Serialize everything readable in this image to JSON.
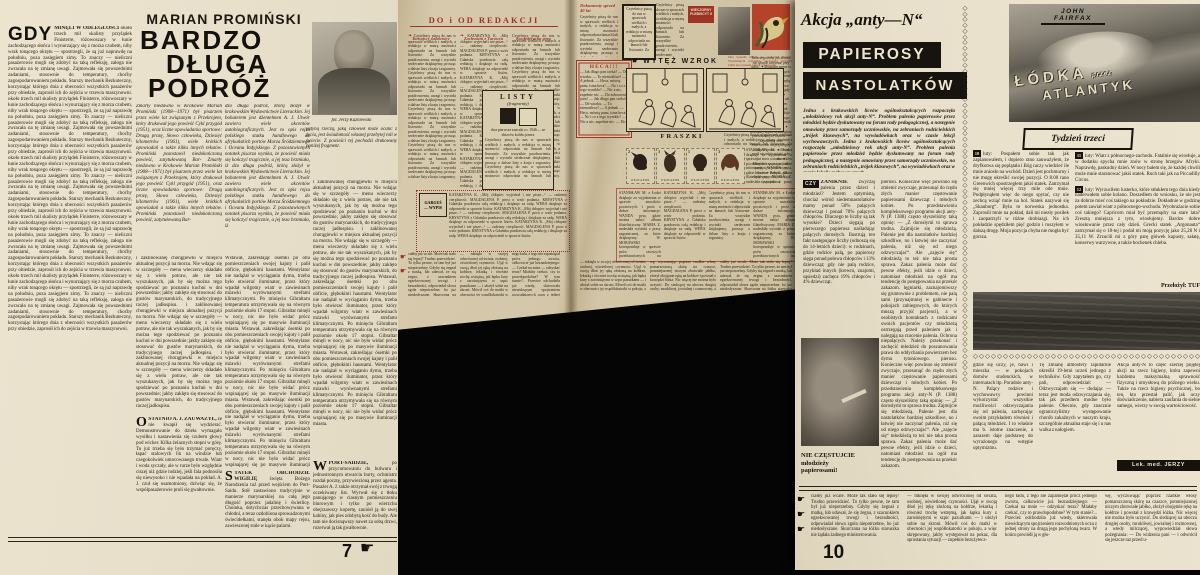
{
  "colors": {
    "background": "#050505",
    "paper_light": "#e8e0cb",
    "paper_tan": "#d4c7a9",
    "ink": "#262016",
    "accent_red": "#9e3425",
    "block_black": "#17130e",
    "stamp_dogs": [
      "#2b2019",
      "#3a2c1f",
      "#322418",
      "#5a3a22"
    ]
  },
  "icons": {
    "hand": "☛",
    "floret": "❧",
    "zigzag": "◇",
    "sep": "✦"
  },
  "p7": {
    "page_number": "7",
    "kicker": "MARIAN PROMIŃSKI",
    "title1": "BARDZO",
    "title2": "DŁUGA",
    "title3": "PODRÓŻ",
    "lead_cap": "GDY",
    "lead_bold": "MINĘLI W ODLEGŁOŚCI",
    "photo_caption": "fot. Jerzy Kuźniewski",
    "secS_cap": "S",
    "secS_head": "TATEK OBCHODZIŁ WIGILIĘ",
    "secW_cap": "W",
    "secW_head": "PORT-SAIDZIE,",
    "secO_cap": "O",
    "secO_head": "STATNIO A. J. ZAUWAŻYŁ,"
  },
  "spread": {
    "header": "DO i OD REDAKCJI",
    "letter_title_1": "Tarnajscy sadownicy",
    "letter_title_2": "Zachwiani z Turowca",
    "letter_title_3": "Konfederacka góra",
    "listy_title": "LISTY",
    "listy_sub": "(fragmenty)",
    "listy_caption": "dwa pierwsze znaczki z r. 1946 — ze zbiorów kolekcjonera",
    "gargus_1": "GARGUŚ",
    "gargus_2": "— WYPIS",
    "doc_title": "Dokumenty sprzed 40 lat",
    "plebiscyt_1": "WIECZORNY",
    "plebiscyt_2": "PLEBISCYT II",
    "heca_title": "HECA!!!",
    "wytez_title": "WYTĘŻ WZROK",
    "wytez_note": "Oba rysunki różnią się pozornie niczym. Wyszukajcie wszystkie szczegóły, którymi różni się rysunek prawy od lewego.",
    "fraszki": "FRASZKI",
    "stamp_label": "БЪЛГАРИЯ",
    "stamp_values": [
      "2",
      "3",
      "1",
      "3"
    ]
  },
  "p10": {
    "kicker": "Akcja „anty—N“",
    "block1": "PAPIEROSY",
    "block2": "NASTOLATKÓW",
    "drop": "CZY",
    "drop_bold": "ZANIKNIE",
    "photo_caption_1": "NIE CZĘSTUJCIE",
    "photo_caption_2": "młodzieży",
    "photo_caption_3": "papierosami!",
    "signature": "Lek. med. JERZY BIRCZYŃSKI",
    "page_number": "10",
    "lodka": {
      "author": "JOHN FAIRFAX",
      "title_1": "ŁÓDKA",
      "title_mid": "przez",
      "title_2": "ATLANTYK",
      "subtitle": "Tydzień trzeci",
      "translator": "Przełożył: TUF",
      "e10_n": "10",
      "e11_n": "11",
      "e12_n": "12"
    }
  },
  "t": {
    "p7_col1": "około trzech mil skalisty przylądek Finisterre, różowoszary w łunie zachodzącego słońca i wynurzający się z morza czubem, niby wrak tonącego okrętu — spostrzegli, że są już naprawdę na południu, poza zasięgiem zimy. To znaczy — nieliczni pasażerowie mogli się zdobyć na taką refleksję, załoga nie zwracała na tę zmianę uwagi. Zajmowała się powszednimi zadaniami, stosownie do temperatury, choćby zagospodarowaniem pokładu. Starszy mechanik Bezkuteczny, korzystając którego dnia z obecności wszystkich pasażerów przy obiedzie, zaprosił ich do zejścia w trzewia maszynowni.",
    "p7_intro_a": "Zmarły niedawno w Krakowie Marian Promiński (1908—1971) był pisarzem przez wiele lat związanym z Przekrojem, który drukował jego powieść Cykl przygód (1951), oraz liczne opowiadania sportowe: Drugą prozę, Słowo człowieka, Dziesięć kilometrów (1961), wiele krótkich opowiadań a także kilka innych tekstów. Promiński pozostawił niedokończoną powieść, zatytułowaną Bar-",
    "p7_intro_b": "dzo długa podróż, którą złożył w krakowskim Wydawnictwie Literackim. Jej bohaterem jest dżentelmen A. J. Utwór zawiera wiele akcentów autobiograficznych. Jest to opis rejsu polskiego statku handlowego do afrykańskich portów Morza Śródziemnego i Oceanu Indyjskiego. Z pozostawionych notatek pisarza wynika, że powieść miała się kończyć tragicznie, a jej teza brzmiała, iż",
    "p7_note": "jedyną rzeczą, jaką człowiek może ocalić z życia, jest świadomość własnej przebytej roli w świecie. Z powieści tej pochodzi drukowany poniżej fragment.",
    "p7_body1": "i zaklinowanej chorągiewki w miejscu aktualnej pozycji na morzu. Nie wdając się w szczegóły — menu wieczerzy składało się z wielu potraw, ale nie tak wyszukanych, jak by się można tego spodziewać po poznaniu kuchni w dni powszednie; jakby zaklęto się stosować do gustów marynarskich, do tradycyjnego raczej jadłospisu.",
    "p7_body2": "Wstawał, zakreślając ósemki po obu pomieszczeniach swojej kajuty i palił obficie, głębokimi haustami. Wentylator nie nadążał w wyciąganiu dymu, trzeba było otwierać iluminator, przez który wpadał wilgotny wiatr w zawiesinach mżawki wyrównanymi strefami klimatycznymi. Po minięciu Gibraltaru temperatura utrzymywała się na równym poziomie około 17 stopni. Gibraltar minęli w nocy, nic nie było widać prócz wspinającej się po masywie iluminacji miasta.",
    "p7_secS": "święta Bożego Narodzenia tuż przed wejściem do Port-Saidu. Stół zastawiono tradycyjnie w manierze marynarskiej na całą jego długość poprzez jadalnię i świetlicę. Choinka, dotychczas przechowywana w chłodni, a teraz ozdobiona sprowadzonymi świecidełkami, stanęła obok mapy rejsu, zawieszonej stale w kącie palarni.",
    "p7_secW": "po przycumowaniu do bulwaru i jednostronnym otwarciu burty, ochmistrz rozdał pocztę, przywiezioną przez agenta. Pasażer A. J. także otrzymał swój z trwogą oczekiwany list. Wyrwał się z tłoku panującego w ciasnym pomieszczeniu biurowym i tylko po wierzchu obejrzawszy kopertę, zaniósł ją do swej kabiny, jak pies zdobytą kość do budy. Ale tam nie docisnąwszy nawet za sobą drzwi, rozerwał ją tak gwałtownie.",
    "p7_secO": "że nie kwapił się wydzierać. Demonstrowanie do dzieła wymagało wysiłku i nastawienia się czubem głowy pod wicher. Kilka żelaznych stopni w górę. Tu już trzeba się było trzymać poręczy, łapać stalowych lin na windzie lub czegokolwiek umocowanego trwale. Wiatr i woda syczały, ale w rurze było względnie ciszej niż gdzie indziej, jeśli fala podnosiła się niewysoko i nie wpadała na pokład. A. J. czuł się osamotniony, dziwiąc się, że współpasażerowie pruli się gwałtownie.",
    "sp_fill": "Czytelnicy piszą do nas w sprawach wielkich i małych, a redakcja w miarę możności odpowiada na łamach lub listownie. Za wszystkie pozdrowienia, uwagi i wycinki serdecznie dziękujemy, prosząc o dalsze listy z kraju i zagranicy.",
    "sp_letters": "KATARZYNA K. „Mój chłopiec wyjechał i nie pisze...“ — radzimy cierpliwość. MAGDALENA P. prosi o wzór podania. KRYSTYNA z Gdańska pozdrawia całą redakcję i dziękuje za radę. WERA dziękuje za odpowiedź w sprawie listów.",
    "sp_letters2": "STANISŁAW M. z Łodzi dziękuje za wyjaśnienia w sprawie znaczków pocztowych i prosi o dalsze informacje. WANDA pyta, gdzie można nabyć album filatelistyczny. MARIA Z. nadesłała wycinki z prasy zagranicznej, za które dziękujemy. W. MORAWSKI koresponduje w sprawie psów rasowych przedstawionych na bułgarskich znaczkach.",
    "sp_heca": "— Jak długo pan czeka? — Od wtorku. — To niemożliwe! — A jednak. — Heca, mówię panu, istna heca! — No i co z tego wynikło? — Nic a nic, zupełnie nic. — Do zobaczenia jutro!",
    "sp_aph": "Twórczego żalu, jak dżemu, nie sposób utrzymać przy sobie. ✦ Rozsądny zapas to kalendarz przewidzianych błędów. ✦ Najtrudniej mieć zmartwienie na przyczepkę cudzych spraw. ✦ Nowa myśl nie zdąży zsiąść, gdy już stara wsiada. ✦ Młodzieńcze, pragnij, ale pamiętaj o powrotnym bilecie. ✦ Prawda, jak zwykle pospolita, nie daje się zacytować.",
    "anty_lead": "Jedna z krakowskich liceów ogólnokształcących rozpoczęła „młodzieżowy rok akcji anty-N“. Problem palenia papierosów przez młodzież będzie dyskutowany na forum rady pedagogicznej, a następnie omawiany przez samorządy uczniowskie, na zebraniach rodzicielskich „trójek klasowych“, na wywiadówkach oraz w czasie lekcji wychowawczych.",
    "anty_c1": "zwyczaj palenia przez dzieci i młodzież? Jestem optymistą, chociaż wśród siedemnastolatków mamy ponad 50% palących dziewcząt i ponad 70% palących chłopców. Dlaczego te liczby są tak wysokie? Dzieci sięgają po pierwszego papierosa naśladując palących dorosłych. Ilustrują ten fakt następujące liczby (odnoszą się do 14-letnich dzieci): w rodzinach, gdzie rodzice palą, po papierosy sięga ponad połowa chłopców i 13% dziewcząt; gdy nie palą rodzice, przykład innych (krewni, znajomi, sąsiedzi) zachęca 19% chłopców i 4% dziewcząt.",
    "anty_c2": "pierosu. Konieczne więc powinno się zmienić zwyczaje, przesunąć do rzędu złych manier częstowanie papierosami dziewcząt i młodych kobiet. Po przedstawieniu kompleksowego programu akcji anty-N (P. 1388) często słyszeliśmy taką opinię: — „Z dorosłymi to sprawa trudna. Zajmijcie się młodzieżą. Palenie jest dla nastolatków bardziej szkodliwe, no i łatwiej nie zaczynać palenia, niż się od niego odzwyczajać“. Ale „zajęcie się“ młodzieżą to też nie taka prosta sprawa. Zakaz palenia może dać pewne efekty, jeśli idzie o dzieci, natomiast młodzież na ogół ma tendencję do postępowania na przekór zakazom.",
    "anty_och": "lęgniarki, zaznajomiwszy się gruntownie z problemem, nie palą sami (przynajmniej w gabinecie i pokojach zabiegowych, do których muszą przyjść pacjenci), a w osobistych kontaktach z rodzicami swoich pacjentów czy młodzieżą ostrzegają przed paleniem jak i nalegają na rzucenie palenia. Ochrona niepalących. Należy przekonać i zachęcić młodzież do poszanowania prawa do oddychania powietrzem bez dymu tytoniowego.",
    "anty_c3": "gdzie się uczy, je, bawi i mieszka — w pokojach domów studenckich, w internatach itp. Poradnie anty-N. Palący rodzice i wychowawcy powinni wykorzystać wszystkie możliwości odzwyczajania się od palenia, zachęcając swoim przykładem również i palącą młodzież. I to właśnie ma b. istotne znaczenie, a zarazem daje podstawę do wyrażonego na wstępie optymizmu.",
    "anty_d1": "Tę zmianę atmosfery lapidarnie określił 19-letni uczeń jednego z techników. Gdy zapytałem go, czy pali, odpowiedział: — Odzwyczajam się — dodając — teraz jest moda odzwyczajania się, tak jak przedtem modne było palenie. Obecnie, gdy znacznie ograniczyliśmy występowanie chorób zakaźnych w naszym kraju, szczególnie aktualna staje się i u nas walka z nałogiem.",
    "anty_d2": "Akcja anty-N to część szerzej pojętej akcji na rzecz higieny, która zapewni każdemu maksymalną sprawność fizyczną i umysłową do późnego wieku. Także na rzecz higieny psychicznej, bo ten, kto przestał palić, jak uczy doświadczenie, nabiera zaufania do siebie samego, wierzy w swoją wartościowość.",
    "lodka_e10": "luty: Pospałem sobie tak jak zaplanowałem, i dopiero rano zauważyłem, że dryfkotwa się poplątała i Bóg raczy wiedzieć ile mnie zniosło na wschód. Dzień jest pochmurny i nie mogę określić swojej pozycji. O 8.00 rano Greenwich spostrzegłem jakiś statek. Zatrzymał się mniej więcej trzy mile ode mnie. Podpłynąłem więc do niego spytać, czy nie zechcą wziąć mnie na hol. Statek nazywał się „Skauborg“. Była to norweska jednostka. Zaprosili mnie na pokład, dali mi niezły posiłek i zaopatrzyli w różne drobiazgi. Na ich pokładzie spędziłem pięć godzin i ruszyłem w dalszą drogę. Moja pozycja chyba nie mogła być gorsza.",
    "lodka_e11": "luty: Wiatr z północnego-zachodu. Fatalnie się wiosłuje, a w dodatku spycha mnie znów w stronę brzegów Afryki. Naprawdę, paskudny dzień. W nocy bałem się, że każdej chwili może mnie staranować jakiś statek. Ruch taki jak na Piccadilly Circus.",
    "lodka_e12": "luty: Wyrzuciłem lusterko, które stłukłem tego dnia kiedy naderwałem sobie kolano. Doszedłem do wniosku, że nie jest za dobrze mieć coś takiego na pokładzie. Dokładnie w godzinę potem zawiał wiatr z północnego-wschodu. Wyobrażacie sobie coś takiego? Capricorn miał być przemądry na stare lata? Zresztą mniejsza z tym, wiosłujemy. Bardzo dobre wiosłowanie przez cały dzień. Grecki statek „Argonauta“ zatrzymał się o 18-tej i podał mi moją pozycję jako 25,28 N i 35,11 W. Zrzucili mi z góry parę główek kapusty, sałatę, konserwy warzywne, a także bochenek chleba.",
    "novel_s1": "ciałby już wcale. Może tak stało się lepiej? Trudno przewidzieć. To tylko pewne, że tam był już niepotrzebny. Gdyby się żegnał z matką, lub udawał, że się żegna, z szacunkiem egzekwowanej trwogi i bezradności, odpowiadał słowa zgoła niepotrzebne, bo już niedosłyszane. Skurczona na łóżku staruszka nie żądała żadnego ministerowania.",
    "novel_s2": "— mknęła w swojej odwróconej od świata, osobnej, oświetlonej czynności. Ujął w swoją dłoń jej rękę złożoną na kołdrze, lekutką i również trochę wstrętną, jak łapka kury z zarośniętymi w szpic pazurkami — i ułożył sobie na skroni. Mówił coś do matki w obecności jej współlokatorki w pokoju, a więc skrępowany, jakby występował na pokaz, dla sprostania sytuacji — zupełnie bezużytecz-",
    "novel_s3": "nego ładu, z tego nie zapamiętał prócz jednego zwrotu, całkowicie już beznadziejnego: — Czekał na mnie — odzyskać teraz? Miałaby czekać, czy to prawdopodobne? W tym stanie?... Przecież odchodziła już wtedy, skierowała niewidzącym spojrzeniem rozwodnionych oczu z jednej strony na drugą jego pochyloną twarz. W końcu powiódł ją w gło-",
    "novel_s4": "wę, wyczuwając poprzez rzadkie włosy pomarszczoną skórę na czaszce, pomniejszonej niczym zbutwiałe jabłko, złożył obojętnie rękę na kołdrze i powstał z krawędzi łóżka. Nic więcej nie można było uczynić. Do siedzącej na uboczu drugiej osoby, mrukliwej, jowialnej i rozmownej, a wtedy milczącej, wypowiedział słowa pożegnania: — Do widzenia pani — i odwrócił się jeszcze raz przed u-"
  }
}
